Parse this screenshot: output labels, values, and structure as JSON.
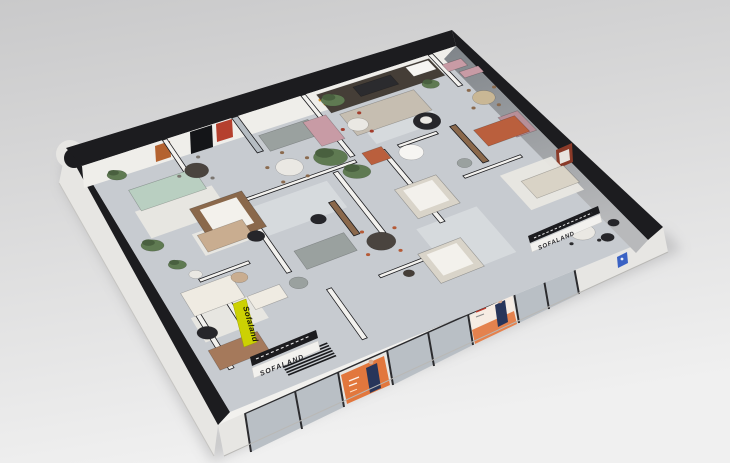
{
  "scene": {
    "description": "3D isometric cutaway render of a furniture showroom floor plan on a gray studio background"
  },
  "brand": {
    "banner_text": "Sofaland",
    "entrance_logo": "SOFALAND",
    "right_logo": "SOFALAND"
  },
  "palette": {
    "bg_top": "#c9c9ca",
    "bg_bottom": "#f0f0f0",
    "band_black": "#1c1c1f",
    "wall_white": "#f2f1ee",
    "wall_int": "#efeeea",
    "wall_face": "#e7e6e3",
    "floor": "#c7cbd0",
    "floor_light": "#d7dadd",
    "rug_white": "#e9e7e1",
    "glass": "#b6bdc3",
    "frame_dark": "#2b2b2e",
    "banner_yellow": "#ccd103",
    "poster_orange": "#e2773d",
    "poster_light": "#f6ece3",
    "figure_navy": "#28355a",
    "skin": "#d8a98e",
    "plaque_blue": "#3a62c4",
    "ne_dark": "#7f8489",
    "ne_light": "#b8b9bb",
    "art_red": "#b5402e",
    "art_orange": "#b4622f",
    "art_rust": "#8a3a28",
    "sofa_mint": "#b9cfc1",
    "sofa_gray": "#9aa19f",
    "sofa_greige": "#c6beb1",
    "sofa_pink": "#c89ba5",
    "sofa_mauve": "#b78f98",
    "sofa_terracotta": "#ba5f3d",
    "sofa_beige": "#d9d3c6",
    "sofa_cream": "#efebe2",
    "sofa_tan": "#c9ad90",
    "sofa_brown": "#a5795b",
    "bed_frame": "#d9d4c9",
    "bed_white": "#f3f1ec",
    "wood_dark": "#453e37",
    "wood_brown": "#8a684b",
    "table_dark": "#4a443f",
    "table_white": "#eae8e3",
    "chair_red": "#a33d2c",
    "chair_orange": "#b55a36",
    "chair_wood": "#8a6a4e",
    "chair_wood_l": "#c9b795",
    "chair_gray": "#7b7670",
    "black_item": "#26262a",
    "plant": "#5f7a52",
    "plant_dark": "#49603f",
    "white_soft": "#f6f5f2",
    "stripe": "#1a1b1e"
  },
  "furniture": [
    {
      "n": "area-rug-light-center",
      "ty": "rug",
      "s": 0.3,
      "t": 0.34,
      "w": 0.2,
      "h": 0.12,
      "c": "floor_light"
    },
    {
      "n": "area-rug-mint",
      "ty": "rug",
      "s": 0.055,
      "t": 0.215,
      "w": 0.2,
      "h": 0.11,
      "c": "rug_white"
    },
    {
      "n": "area-rug-shelf-room",
      "ty": "rug",
      "s": 0.66,
      "t": 0.13,
      "w": 0.17,
      "h": 0.14,
      "c": "floor_light"
    },
    {
      "n": "area-rug-right-beige",
      "ty": "rug",
      "s": 0.845,
      "t": 0.55,
      "w": 0.13,
      "h": 0.17,
      "c": "rug_white"
    },
    {
      "n": "area-rug-cream",
      "ty": "rug",
      "s": 0.035,
      "t": 0.64,
      "w": 0.155,
      "h": 0.1,
      "c": "rug_white"
    },
    {
      "n": "area-rug-bottom-right",
      "ty": "rug",
      "s": 0.6,
      "t": 0.63,
      "w": 0.15,
      "h": 0.22,
      "c": "floor_light"
    },
    {
      "n": "area-rug-tan",
      "ty": "rug",
      "s": 0.145,
      "t": 0.36,
      "w": 0.13,
      "h": 0.09,
      "c": "rug_white"
    },
    {
      "n": "partition-wall-a",
      "ty": "wall",
      "s": 0.215,
      "t": 0.0,
      "w": 0.012,
      "h": 0.21
    },
    {
      "n": "glass-brick-partition",
      "ty": "wall",
      "s": 0.4,
      "t": 0.0,
      "w": 0.016,
      "h": 0.155,
      "c": "glass"
    },
    {
      "n": "partition-wall-b",
      "ty": "wall",
      "s": 0.585,
      "t": 0.0,
      "w": 0.012,
      "h": 0.285
    },
    {
      "n": "partition-wall-c",
      "ty": "wall",
      "s": 0.925,
      "t": 0.0,
      "w": 0.012,
      "h": 0.16
    },
    {
      "n": "partition-wall-long",
      "ty": "wall",
      "s": 0.22,
      "t": 0.3,
      "w": 0.37,
      "h": 0.012
    },
    {
      "n": "partition-wall-d",
      "ty": "wall",
      "s": 0.285,
      "t": 0.312,
      "w": 0.012,
      "h": 0.3
    },
    {
      "n": "partition-wall-e",
      "ty": "wall",
      "s": 0.525,
      "t": 0.32,
      "w": 0.012,
      "h": 0.28
    },
    {
      "n": "partition-wall-f",
      "ty": "wall",
      "s": 0.655,
      "t": 0.3,
      "w": 0.012,
      "h": 0.34
    },
    {
      "n": "bath-wall",
      "ty": "wall",
      "s": 0.7,
      "t": 0.3,
      "w": 0.1,
      "h": 0.012
    },
    {
      "n": "partition-wall-g",
      "ty": "wall",
      "s": 0.775,
      "t": 0.5,
      "w": 0.145,
      "h": 0.012
    },
    {
      "n": "partition-wall-h",
      "ty": "wall",
      "s": 0.1,
      "t": 0.52,
      "w": 0.125,
      "h": 0.012
    },
    {
      "n": "partition-wall-i",
      "ty": "wall",
      "s": 0.048,
      "t": 0.6,
      "w": 0.012,
      "h": 0.26
    },
    {
      "n": "banner-wall",
      "ty": "wall",
      "s": 0.125,
      "t": 0.63,
      "w": 0.012,
      "h": 0.17
    },
    {
      "n": "partition-wall-j",
      "ty": "wall",
      "s": 0.34,
      "t": 0.72,
      "w": 0.012,
      "h": 0.22
    },
    {
      "n": "partition-wall-k",
      "ty": "wall",
      "s": 0.46,
      "t": 0.74,
      "w": 0.13,
      "h": 0.012
    },
    {
      "n": "wood-glass-partition-right",
      "ty": "wall",
      "s": 0.835,
      "t": 0.3,
      "w": 0.015,
      "h": 0.18,
      "c": "wood_brown"
    },
    {
      "n": "wood-glass-partition-center",
      "ty": "wall",
      "s": 0.47,
      "t": 0.42,
      "w": 0.015,
      "h": 0.15,
      "c": "wood_brown"
    },
    {
      "n": "wall-shelving-unit",
      "ty": "quad",
      "s": 0.62,
      "t": 0.015,
      "w": 0.3,
      "h": 0.085,
      "c": "wood_dark"
    },
    {
      "n": "tv-panel",
      "ty": "quad",
      "s": 0.71,
      "t": 0.03,
      "w": 0.1,
      "h": 0.045,
      "c": "frame_dark"
    },
    {
      "n": "canopy-bed-wood",
      "ty": "bed",
      "s": 0.175,
      "t": 0.27,
      "w": 0.135,
      "h": 0.155,
      "c": "wood_brown"
    },
    {
      "n": "bed-white-center",
      "ty": "bed",
      "s": 0.62,
      "t": 0.46,
      "w": 0.105,
      "h": 0.135,
      "c": "bed_frame"
    },
    {
      "n": "bed-white-front",
      "ty": "bed",
      "s": 0.565,
      "t": 0.72,
      "w": 0.105,
      "h": 0.135,
      "c": "bed_frame"
    },
    {
      "n": "sofa-mint",
      "ty": "quad",
      "s": 0.07,
      "t": 0.135,
      "w": 0.17,
      "h": 0.085,
      "c": "sofa_mint"
    },
    {
      "n": "sofa-gray",
      "ty": "quad",
      "s": 0.43,
      "t": 0.095,
      "w": 0.13,
      "h": 0.07,
      "c": "sofa_gray"
    },
    {
      "n": "sectional-greige",
      "ty": "quad",
      "s": 0.635,
      "t": 0.115,
      "w": 0.195,
      "h": 0.1,
      "c": "sofa_greige"
    },
    {
      "n": "sofa-pink",
      "ty": "quad",
      "s": 0.545,
      "t": 0.1,
      "w": 0.06,
      "h": 0.11,
      "c": "sofa_pink"
    },
    {
      "n": "sofa-mauve",
      "ty": "quad",
      "s": 0.945,
      "t": 0.33,
      "w": 0.05,
      "h": 0.1,
      "c": "sofa_mauve"
    },
    {
      "n": "sofa-terracotta",
      "ty": "quad",
      "s": 0.875,
      "t": 0.345,
      "w": 0.105,
      "h": 0.08,
      "c": "sofa_terracotta"
    },
    {
      "n": "loveseat-terracotta",
      "ty": "quad",
      "s": 0.615,
      "t": 0.285,
      "w": 0.05,
      "h": 0.055,
      "c": "sofa_terracotta"
    },
    {
      "n": "sofa-beige",
      "ty": "quad",
      "s": 0.875,
      "t": 0.6,
      "w": 0.105,
      "h": 0.085,
      "c": "sofa_beige"
    },
    {
      "n": "sofa-cream",
      "ty": "quad",
      "s": 0.045,
      "t": 0.545,
      "w": 0.125,
      "h": 0.095,
      "c": "sofa_cream"
    },
    {
      "n": "sofa-tan",
      "ty": "quad",
      "s": 0.155,
      "t": 0.37,
      "w": 0.115,
      "h": 0.07,
      "c": "sofa_tan"
    },
    {
      "n": "sofa-brown",
      "ty": "quad",
      "s": 0.03,
      "t": 0.77,
      "w": 0.12,
      "h": 0.08,
      "c": "sofa_brown"
    },
    {
      "n": "sofa-gray-chaise",
      "ty": "quad",
      "s": 0.33,
      "t": 0.545,
      "w": 0.125,
      "h": 0.08,
      "c": "sofa_gray"
    },
    {
      "n": "loveseat-white",
      "ty": "quad",
      "s": 0.175,
      "t": 0.64,
      "w": 0.08,
      "h": 0.055,
      "c": "sofa_cream"
    },
    {
      "n": "vanity-counter-pink-a",
      "ty": "quad",
      "s": 0.935,
      "t": 0.055,
      "w": 0.05,
      "h": 0.035,
      "c": "sofa_pink"
    },
    {
      "n": "vanity-counter-pink-b",
      "ty": "quad",
      "s": 0.955,
      "t": 0.105,
      "w": 0.05,
      "h": 0.03,
      "c": "sofa_pink"
    },
    {
      "n": "cabinet-white",
      "ty": "quad",
      "s": 0.855,
      "t": 0.02,
      "w": 0.06,
      "h": 0.045,
      "c": "white_soft"
    },
    {
      "n": "dining-table-dark-orange-chairs",
      "ty": "round",
      "s": 0.515,
      "t": 0.625,
      "r": 0.034,
      "c": "table_dark",
      "dn": 4,
      "dc": "chair_orange"
    },
    {
      "n": "dining-table-den",
      "ty": "round",
      "s": 0.245,
      "t": 0.145,
      "r": 0.03,
      "c": "table_dark",
      "dn": 3,
      "dc": "chair_gray"
    },
    {
      "n": "dining-table-round-white",
      "ty": "round",
      "s": 0.445,
      "t": 0.245,
      "r": 0.034,
      "c": "table_white",
      "dn": 5,
      "dc": "chair_wood"
    },
    {
      "n": "dining-table-right",
      "ty": "round",
      "s": 0.9,
      "t": 0.875,
      "r": 0.028,
      "c": "table_white",
      "dn": 4,
      "dc": "frame_dark"
    },
    {
      "n": "dining-table-topright",
      "ty": "round",
      "s": 0.955,
      "t": 0.235,
      "r": 0.028,
      "c": "chair_wood_l",
      "dn": 4,
      "dc": "chair_wood"
    },
    {
      "n": "dining-table-red-chairs",
      "ty": "round",
      "s": 0.655,
      "t": 0.175,
      "r": 0.026,
      "c": "table_white",
      "dn": 3,
      "dc": "chair_red"
    },
    {
      "n": "rug-round-black",
      "ty": "dot",
      "s": 0.8,
      "t": 0.25,
      "r": 0.034,
      "c": "black_item"
    },
    {
      "n": "coffee-table-white",
      "ty": "dot",
      "s": 0.8,
      "t": 0.245,
      "r": 0.015,
      "c": "table_white"
    },
    {
      "n": "coffee-table-black-a",
      "ty": "dot",
      "s": 0.275,
      "t": 0.445,
      "r": 0.021,
      "c": "black_item"
    },
    {
      "n": "coffee-table-black-b",
      "ty": "dot",
      "s": 0.425,
      "t": 0.465,
      "r": 0.019,
      "c": "black_item"
    },
    {
      "n": "egg-chair-black",
      "ty": "dot",
      "s": 0.05,
      "t": 0.71,
      "r": 0.024,
      "c": "black_item"
    },
    {
      "n": "chair-rattan",
      "ty": "dot",
      "s": 0.185,
      "t": 0.565,
      "r": 0.02,
      "c": "sofa_tan"
    },
    {
      "n": "beanbag-gray",
      "ty": "dot",
      "s": 0.295,
      "t": 0.66,
      "r": 0.022,
      "c": "sofa_gray"
    },
    {
      "n": "pouf-gray",
      "ty": "dot",
      "s": 0.8,
      "t": 0.455,
      "r": 0.018,
      "c": "sofa_gray"
    },
    {
      "n": "bathtub-white",
      "ty": "dot",
      "s": 0.715,
      "t": 0.345,
      "r": 0.03,
      "c": "white_soft"
    },
    {
      "n": "coat-rack",
      "ty": "dot",
      "s": 0.52,
      "t": 0.775,
      "r": 0.013,
      "c": "wood_dark"
    },
    {
      "n": "mirror-oval",
      "ty": "dot",
      "s": 0.1,
      "t": 0.5,
      "r": 0.016,
      "c": "table_white"
    },
    {
      "n": "chair-black-a",
      "ty": "dot",
      "s": 0.935,
      "t": 0.93,
      "r": 0.015,
      "c": "black_item"
    },
    {
      "n": "chair-black-b",
      "ty": "dot",
      "s": 0.97,
      "t": 0.885,
      "r": 0.013,
      "c": "black_item"
    },
    {
      "n": "plant-center-tall",
      "ty": "plant",
      "s": 0.545,
      "t": 0.26,
      "r": 0.042
    },
    {
      "n": "plant-center-low",
      "ty": "plant",
      "s": 0.575,
      "t": 0.345,
      "r": 0.034
    },
    {
      "n": "plant-top",
      "ty": "plant",
      "s": 0.645,
      "t": 0.055,
      "r": 0.03
    },
    {
      "n": "plant-west",
      "ty": "plant",
      "s": 0.065,
      "t": 0.07,
      "r": 0.025
    },
    {
      "n": "plant-left-mid",
      "ty": "plant",
      "s": 0.048,
      "t": 0.35,
      "r": 0.028
    },
    {
      "n": "plant-topright",
      "ty": "plant",
      "s": 0.875,
      "t": 0.115,
      "r": 0.022
    },
    {
      "n": "plant-bottomleft",
      "ty": "plant",
      "s": 0.075,
      "t": 0.445,
      "r": 0.022
    },
    {
      "n": "striped-entry-rug",
      "ty": "stripes",
      "s": 0.155,
      "t": 0.9,
      "w": 0.115,
      "h": 0.065,
      "c": "stripe"
    }
  ]
}
